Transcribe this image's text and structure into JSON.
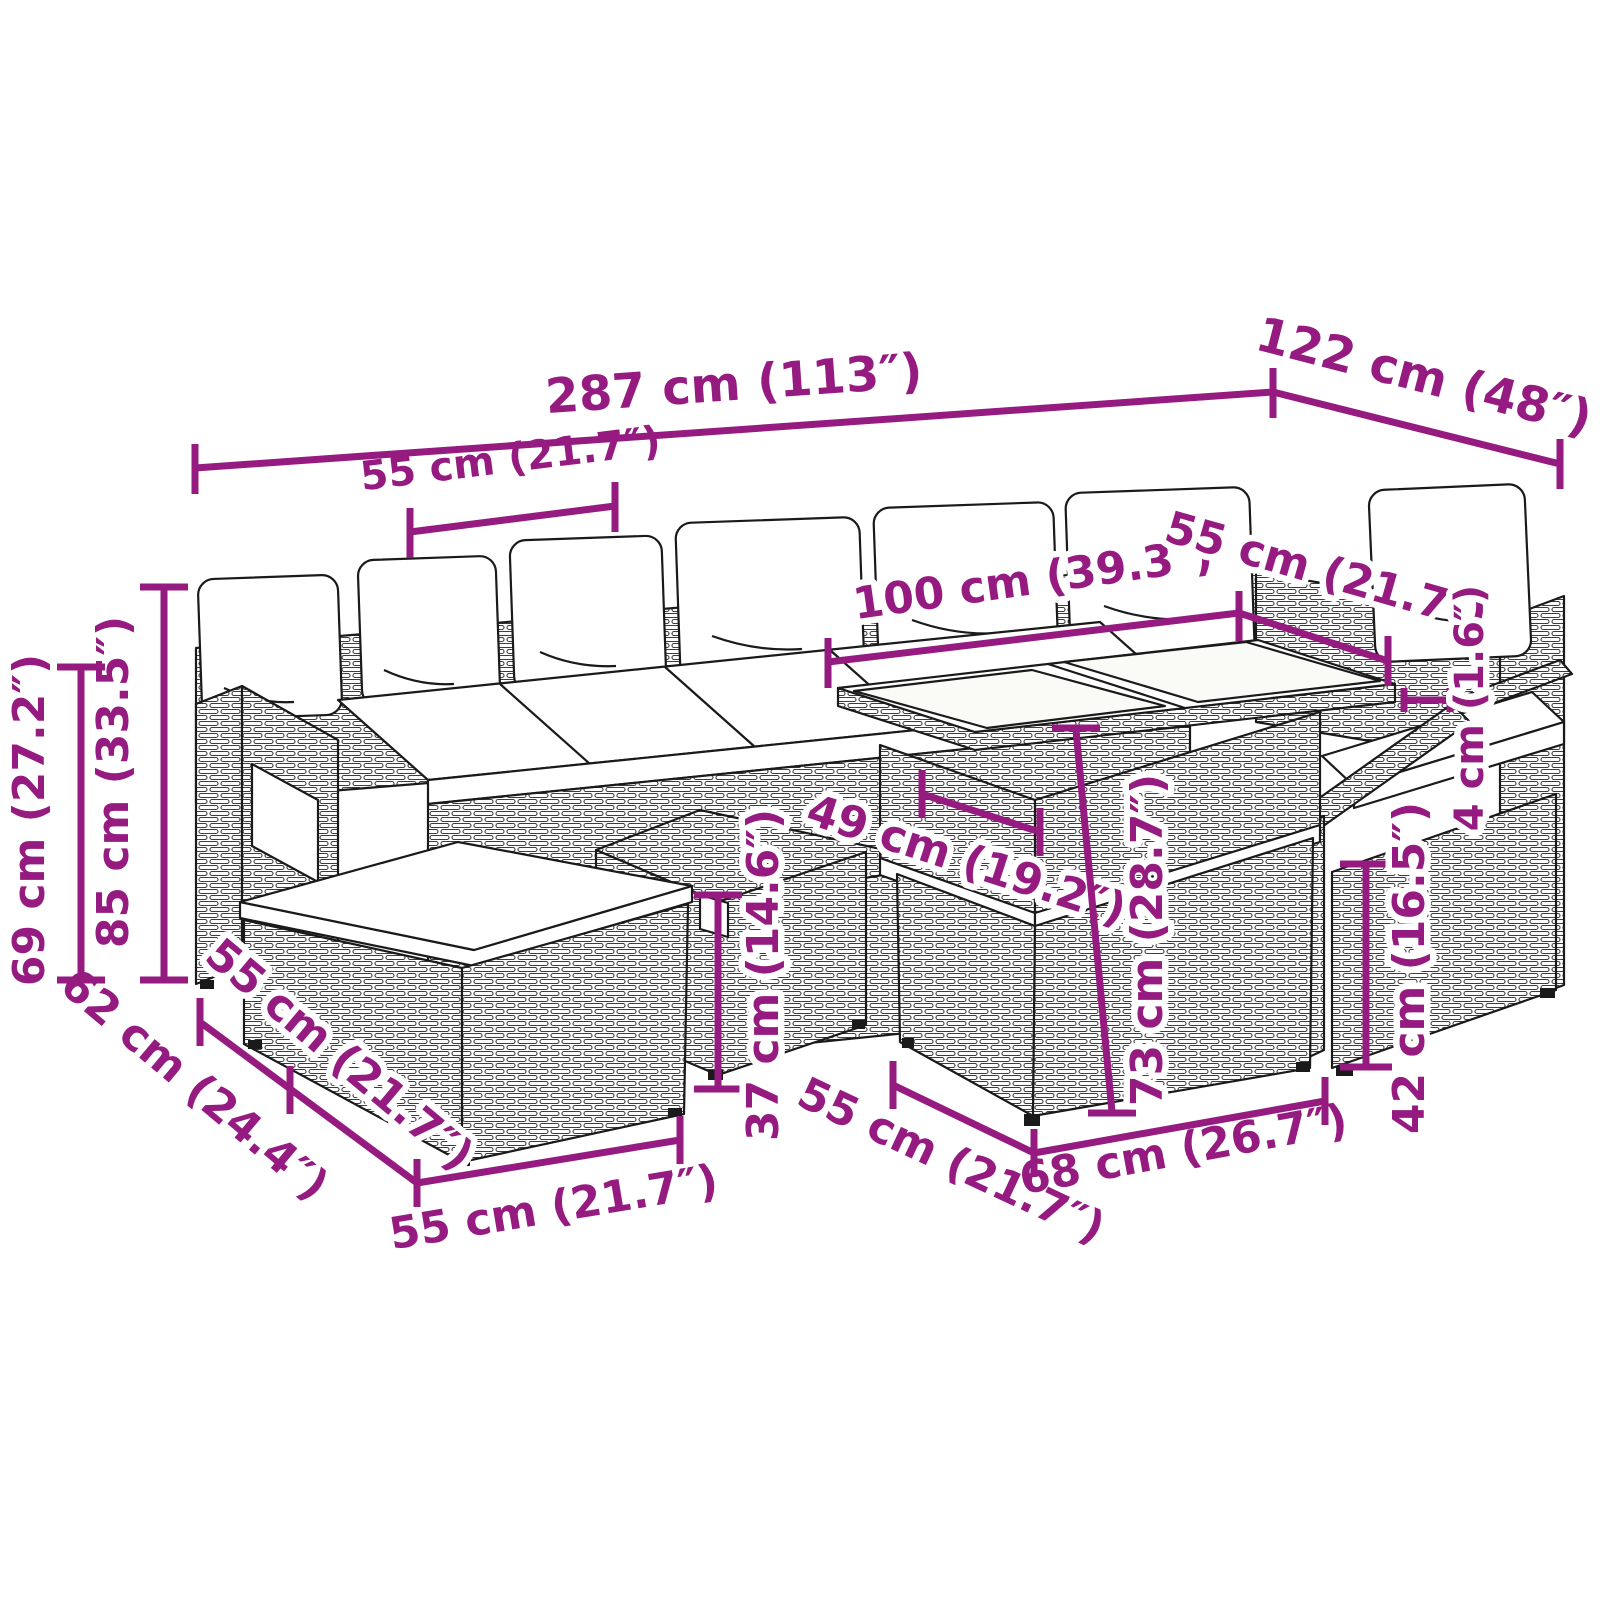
{
  "diagram": {
    "type": "product-dimension-diagram",
    "subject": "rattan garden lounge set with cushions, ottomans, dining table and chair"
  },
  "colors": {
    "dimension_accent": "#951B81",
    "line_art": "#1a1a1a",
    "background": "#ffffff"
  },
  "dimensions": {
    "dim_287": "287 cm (113″)",
    "dim_122": "122 cm (48″)",
    "dim_55_top": "55 cm (21.7″)",
    "dim_100": "100 cm (39.3″)",
    "dim_55_right": "55 cm (21.7″)",
    "dim_49": "49 cm (19.2″)",
    "dim_73": "73 cm (28.7″)",
    "dim_37": "37 cm (14.6″)",
    "dim_42": "42 cm (16.5″)",
    "dim_4": "4 cm (1.6″)",
    "dim_85": "85 cm (33.5″)",
    "dim_69": "69 cm (27.2″)",
    "dim_62": "62 cm (24.4″)",
    "dim_55_ottoman_edge": "55 cm (21.7″)",
    "dim_55_mid": "55 cm (21.7″)",
    "dim_68": "68 cm (26.7″)",
    "dim_55_bottom": "55 cm (21.7″)"
  }
}
